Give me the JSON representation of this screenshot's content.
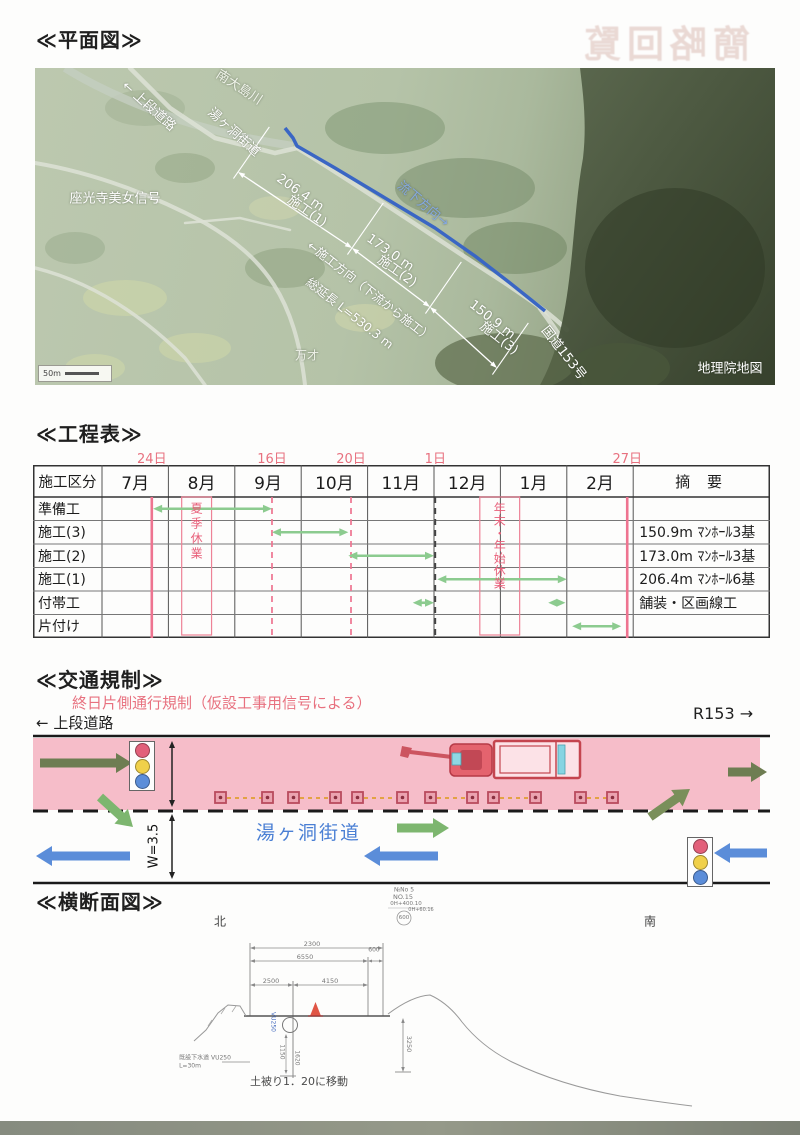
{
  "sections": {
    "plan": "≪平面図≫",
    "schedule": "≪工程表≫",
    "traffic": "≪交通規制≫",
    "cross_section": "≪横断面図≫"
  },
  "page": {
    "bleedthrough_stamp": "簡略回覧"
  },
  "map": {
    "scale_label": "50m",
    "route_color": "#3a66c4",
    "annotations": [
      {
        "t": "南大島川",
        "x": 205,
        "y": 18,
        "r": 33,
        "fs": 13,
        "c": "#f0f4ea"
      },
      {
        "t": "← 上段道路",
        "x": 115,
        "y": 37,
        "r": 42,
        "fs": 13,
        "c": "#ffffff"
      },
      {
        "t": "湯ヶ洞街道",
        "x": 200,
        "y": 63,
        "r": 42,
        "fs": 13,
        "c": "#ffffff"
      },
      {
        "t": "座光寺美女信号",
        "x": 80,
        "y": 129,
        "r": 0,
        "fs": 13,
        "c": "#ffffff"
      },
      {
        "t": "流下方向→",
        "x": 389,
        "y": 135,
        "r": 40,
        "fs": 13,
        "c": "#85a9e0"
      },
      {
        "t": "206.4 m",
        "x": 265,
        "y": 125,
        "r": 35,
        "fs": 13,
        "c": "#ffffff"
      },
      {
        "t": "施工(1)",
        "x": 273,
        "y": 142,
        "r": 35,
        "fs": 13,
        "c": "#ffffff"
      },
      {
        "t": "173.0 m",
        "x": 355,
        "y": 185,
        "r": 35,
        "fs": 13,
        "c": "#ffffff"
      },
      {
        "t": "施工(2)",
        "x": 363,
        "y": 202,
        "r": 35,
        "fs": 13,
        "c": "#ffffff"
      },
      {
        "t": "150.9 m",
        "x": 457,
        "y": 252,
        "r": 38,
        "fs": 13,
        "c": "#ffffff"
      },
      {
        "t": "施工(3)",
        "x": 465,
        "y": 269,
        "r": 38,
        "fs": 13,
        "c": "#ffffff"
      },
      {
        "t": "←施工方向（下流から施工）",
        "x": 335,
        "y": 223,
        "r": 38,
        "fs": 12,
        "c": "#ffffff"
      },
      {
        "t": "総延長 L=530.3 m",
        "x": 315,
        "y": 245,
        "r": 38,
        "fs": 12,
        "c": "#ffffff"
      },
      {
        "t": "万才",
        "x": 272,
        "y": 287,
        "r": 0,
        "fs": 12,
        "c": "#eef1e8"
      },
      {
        "t": "国道153号",
        "x": 530,
        "y": 284,
        "r": 52,
        "fs": 13,
        "c": "#ffffff"
      },
      {
        "t": "地理院地図",
        "x": 695,
        "y": 299,
        "r": 0,
        "fs": 13,
        "c": "#ffffff"
      }
    ]
  },
  "chart_data": {
    "type": "table",
    "title": "工程表",
    "columns": [
      "施工区分",
      "7月",
      "8月",
      "9月",
      "10月",
      "11月",
      "12月",
      "1月",
      "2月",
      "摘 要"
    ],
    "rows": [
      {
        "task": "準備工",
        "period": "7/24-9/16",
        "remark": ""
      },
      {
        "task": "施工(3)",
        "period": "9/16-10/20",
        "remark": "150.9m ﾏﾝﾎｰﾙ3基"
      },
      {
        "task": "施工(2)",
        "period": "10/20-12/1",
        "remark": "173.0m ﾏﾝﾎｰﾙ3基"
      },
      {
        "task": "施工(1)",
        "period": "12/1-2/1",
        "remark": "206.4m ﾏﾝﾎｰﾙ6基"
      },
      {
        "task": "付帯工",
        "period": "11月末, 1月末",
        "remark": "舗装・区画線工"
      },
      {
        "task": "片付け",
        "period": "2/1-2/27",
        "remark": ""
      }
    ]
  },
  "schedule": {
    "header": [
      "施工区分",
      "7月",
      "8月",
      "9月",
      "10月",
      "11月",
      "12月",
      "1月",
      "2月",
      "摘 要"
    ],
    "date_marks": [
      {
        "label": "24日",
        "pos": 0.75,
        "style": "solid"
      },
      {
        "label": "16日",
        "pos": 2.56,
        "style": "dashed"
      },
      {
        "label": "20日",
        "pos": 3.75,
        "style": "dashed"
      },
      {
        "label": "1日",
        "pos": 5.02,
        "style": "dashed-dark"
      },
      {
        "label": "27日",
        "pos": 7.91,
        "style": "solid"
      }
    ],
    "rows": [
      {
        "label": "準備工",
        "remark": "",
        "bars": [
          [
            0.77,
            2.56
          ]
        ]
      },
      {
        "label": "施工(3)",
        "remark": "150.9m ﾏﾝﾎｰﾙ3基",
        "bars": [
          [
            2.56,
            3.71
          ]
        ]
      },
      {
        "label": "施工(2)",
        "remark": "173.0m ﾏﾝﾎｰﾙ3基",
        "bars": [
          [
            3.71,
            5.0
          ]
        ]
      },
      {
        "label": "施工(1)",
        "remark": "206.4m ﾏﾝﾎｰﾙ6基",
        "bars": [
          [
            5.05,
            7.0
          ]
        ]
      },
      {
        "label": "付帯工",
        "remark": "舗装・区画線工",
        "bars": [
          [
            4.68,
            5.0
          ],
          [
            6.72,
            6.98
          ]
        ]
      },
      {
        "label": "片付け",
        "remark": "",
        "bars": [
          [
            7.08,
            7.82
          ]
        ]
      }
    ],
    "holidays": [
      {
        "label": "夏季休業",
        "from": 1.2,
        "to": 1.65
      },
      {
        "label": "年末・年始休業",
        "from": 5.69,
        "to": 6.29
      }
    ],
    "bar_color": "#8ccb8f",
    "mark_color": "#ee7490"
  },
  "traffic": {
    "subtitle": "終日片側通行規制（仮設工事用信号による）",
    "left_label": "← 上段道路",
    "right_label": "R153 →",
    "street": "湯ヶ洞街道",
    "lane_top_width": "W=3.5",
    "lane_bottom_width": "W=3.5",
    "lane_color": "#f6bdc9",
    "signal_colors": [
      "#e2607a",
      "#f0d04a",
      "#5b8dd9"
    ],
    "arrows": [
      {
        "x1": 40,
        "y1": 763,
        "x2": 132,
        "y2": 763,
        "c": "#6e7d52"
      },
      {
        "x1": 728,
        "y1": 772,
        "x2": 767,
        "y2": 772,
        "c": "#6e7d52"
      },
      {
        "x1": 100,
        "y1": 797,
        "x2": 133,
        "y2": 827,
        "c": "#7db66f"
      },
      {
        "x1": 397,
        "y1": 828,
        "x2": 449,
        "y2": 828,
        "c": "#7db66f"
      },
      {
        "x1": 650,
        "y1": 817,
        "x2": 690,
        "y2": 789,
        "c": "#7a8f5a"
      },
      {
        "x1": 130,
        "y1": 856,
        "x2": 36,
        "y2": 856,
        "c": "#5b8dd9"
      },
      {
        "x1": 438,
        "y1": 856,
        "x2": 364,
        "y2": 856,
        "c": "#5b8dd9"
      },
      {
        "x1": 767,
        "y1": 853,
        "x2": 714,
        "y2": 853,
        "c": "#5b8dd9"
      }
    ],
    "cone_pairs": [
      [
        215,
        262
      ],
      [
        288,
        330
      ],
      [
        352,
        397
      ],
      [
        425,
        467
      ],
      [
        488,
        530
      ],
      [
        575,
        607
      ]
    ]
  },
  "cross_section": {
    "labels": [
      {
        "t": "北",
        "x": 220,
        "y": 921,
        "fs": 12,
        "c": "#444"
      },
      {
        "t": "南",
        "x": 650,
        "y": 921,
        "fs": 12,
        "c": "#444"
      },
      {
        "t": "№No 5",
        "x": 404,
        "y": 890,
        "fs": 6
      },
      {
        "t": "NO.15",
        "x": 403,
        "y": 897,
        "fs": 6.5
      },
      {
        "t": "0H+400.10",
        "x": 406,
        "y": 904,
        "fs": 5.5
      },
      {
        "t": "0H+60.16",
        "x": 421,
        "y": 910,
        "fs": 5
      },
      {
        "t": "600",
        "x": 404,
        "y": 918,
        "fs": 5.5
      },
      {
        "t": "2300",
        "x": 312,
        "y": 944,
        "fs": 6.5
      },
      {
        "t": "6550",
        "x": 305,
        "y": 957,
        "fs": 6.5
      },
      {
        "t": "600",
        "x": 374,
        "y": 950,
        "fs": 6
      },
      {
        "t": "2500",
        "x": 271,
        "y": 981,
        "fs": 6.5
      },
      {
        "t": "4150",
        "x": 330,
        "y": 981,
        "fs": 6.5
      },
      {
        "t": "3250",
        "x": 409,
        "y": 1044,
        "fs": 6.5,
        "r": 90
      },
      {
        "t": "1150",
        "x": 282,
        "y": 1052,
        "fs": 6,
        "r": 90
      },
      {
        "t": "1620",
        "x": 297,
        "y": 1058,
        "fs": 6,
        "r": 90
      },
      {
        "t": "VU250",
        "x": 273,
        "y": 1022,
        "fs": 6,
        "r": 90,
        "c": "#4a6fc0"
      },
      {
        "t": "既設下水道 VU250",
        "x": 205,
        "y": 1057,
        "fs": 6
      },
      {
        "t": "L=30m",
        "x": 190,
        "y": 1066,
        "fs": 6
      },
      {
        "t": "土被り1．20に移動",
        "x": 299,
        "y": 1081,
        "fs": 11,
        "c": "#4a4a4a"
      }
    ]
  }
}
